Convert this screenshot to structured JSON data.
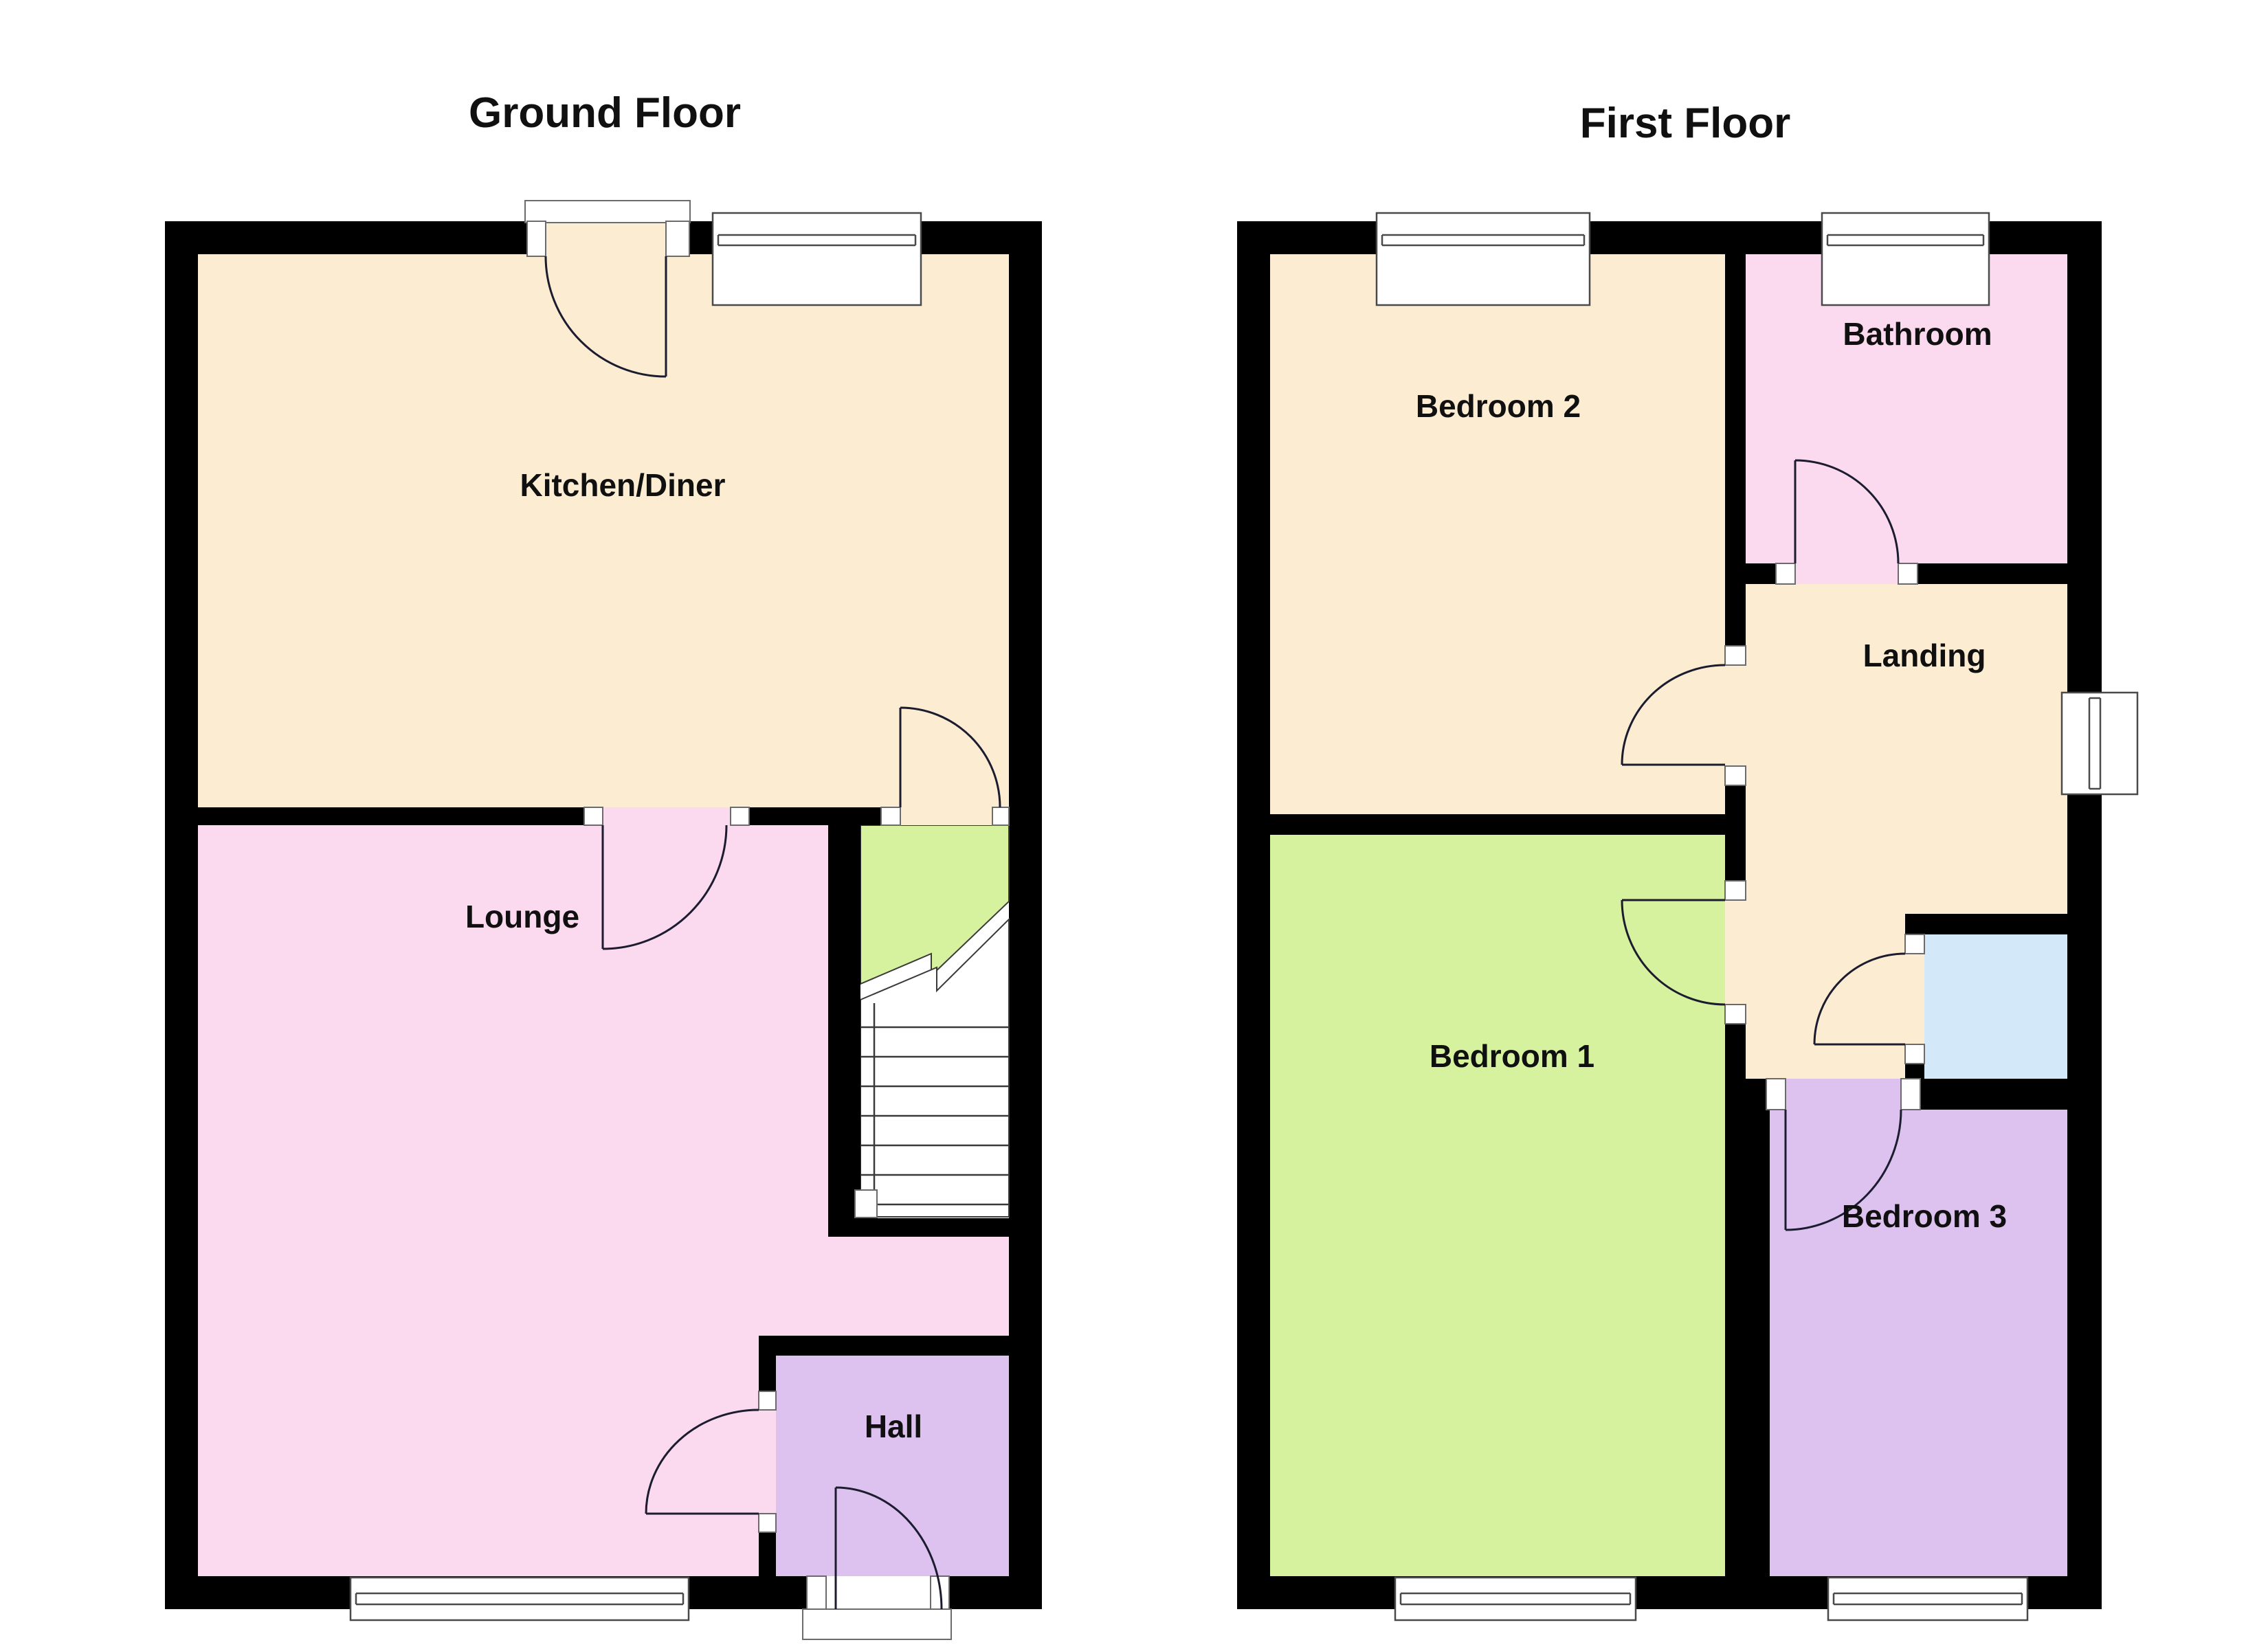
{
  "ground_floor": {
    "title": "Ground Floor",
    "rooms": [
      {
        "name": "kitchen-diner",
        "label": "Kitchen/Diner",
        "color": "#fbecd2"
      },
      {
        "name": "lounge",
        "label": "Lounge",
        "color": "#fbd9ee"
      },
      {
        "name": "hall",
        "label": "Hall",
        "color": "#ddc2ef"
      },
      {
        "name": "stairs",
        "label": "",
        "color": "#d6f29e"
      }
    ]
  },
  "first_floor": {
    "title": "First Floor",
    "rooms": [
      {
        "name": "bedroom-2",
        "label": "Bedroom 2",
        "color": "#fbecd2"
      },
      {
        "name": "bathroom",
        "label": "Bathroom",
        "color": "#fbd9ee"
      },
      {
        "name": "landing",
        "label": "Landing",
        "color": "#fbecd2"
      },
      {
        "name": "bedroom-1",
        "label": "Bedroom 1",
        "color": "#d6f29e"
      },
      {
        "name": "bedroom-3",
        "label": "Bedroom 3",
        "color": "#ddc2ef"
      },
      {
        "name": "airing-cupboard",
        "label": "",
        "color": "#d3e9f9"
      }
    ]
  },
  "style": {
    "wall_color": "#000000",
    "door_line_color": "#1c1c30",
    "window_line_color": "#4a4a4a",
    "text_color": "#101010",
    "background": "#ffffff"
  }
}
